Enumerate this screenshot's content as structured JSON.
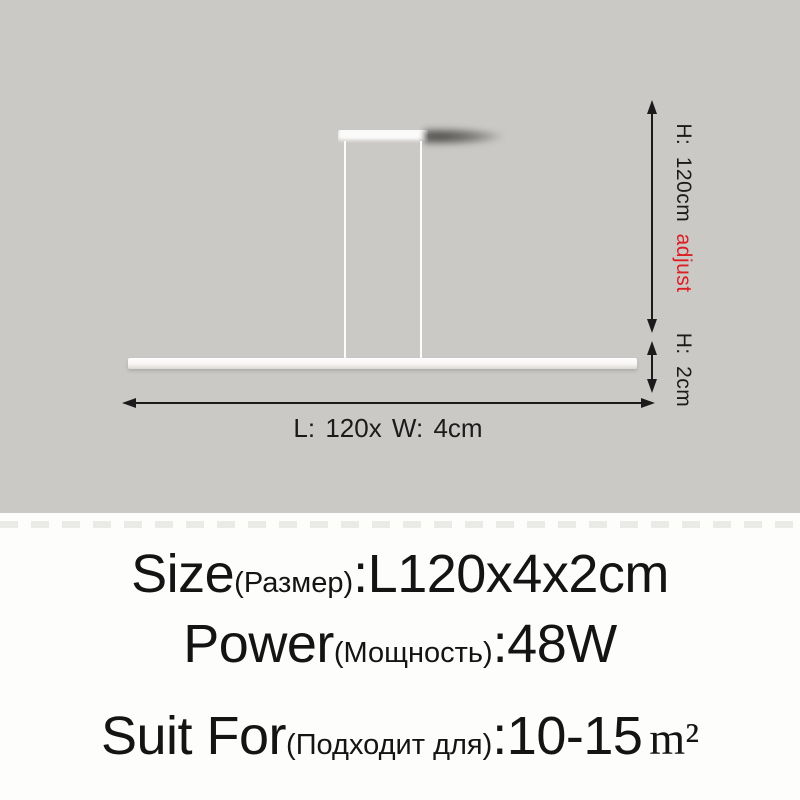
{
  "colors": {
    "photo_bg": "#cac9c6",
    "panel_bg": "#fdfdfc",
    "ink": "#1b1b1b",
    "accent_red": "#dc1f25",
    "lamp_white": "#fbfbfa"
  },
  "diagram": {
    "height_label": "H: 120cm",
    "height_adjust_label": "adjust",
    "bar_height_label": "H: 2cm",
    "length_label": "L: 120x W: 4cm"
  },
  "specs": [
    {
      "label_en": "Size",
      "label_ru": "(Размер)",
      "value": ":L120x4x2cm"
    },
    {
      "label_en": "Power",
      "label_ru": "(Мощность)",
      "value": ":48W"
    },
    {
      "label_en": "Suit For",
      "label_ru": "(Подходит для)",
      "value": ":10-15",
      "unit": "m²"
    }
  ]
}
